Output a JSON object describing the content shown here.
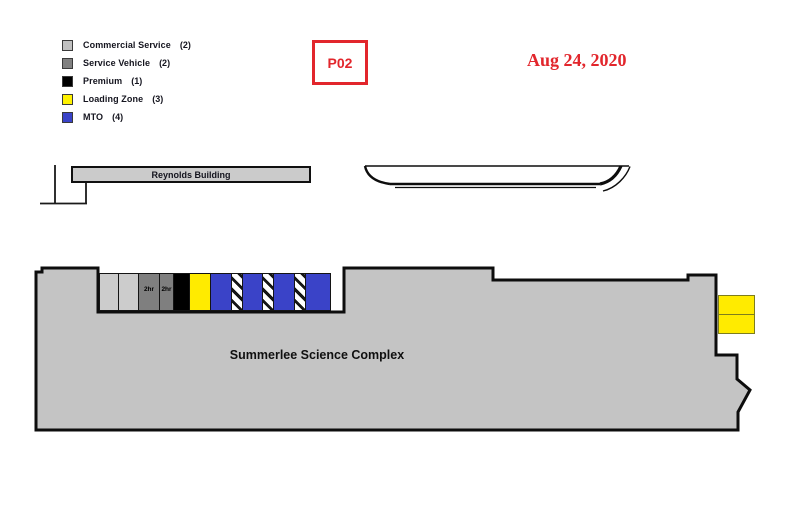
{
  "map_label": {
    "text": "P02",
    "color": "#E2262C"
  },
  "date": {
    "text": "Aug 24, 2020",
    "color": "#E2262C"
  },
  "legend": {
    "items": [
      {
        "label": "Commercial Service",
        "count": "(2)",
        "color": "#C0C0C0"
      },
      {
        "label": "Service Vehicle",
        "count": "(2)",
        "color": "#808080"
      },
      {
        "label": "Premium",
        "count": "(1)",
        "color": "#000000"
      },
      {
        "label": "Loading Zone",
        "count": "(3)",
        "color": "#FFF200"
      },
      {
        "label": "MTO",
        "count": "(4)",
        "color": "#3A43C8"
      }
    ]
  },
  "buildings": {
    "reynolds": {
      "name": "Reynolds Building"
    },
    "summerlee": {
      "name": "Summerlee Science Complex"
    }
  },
  "parking": {
    "stall_colors": {
      "commercial": "#CCCCCC",
      "service": "#7F7F7F",
      "premium": "#000000",
      "loading": "#FFEB00",
      "mto": "#3A43C8",
      "hatched": "#FFFFFF"
    },
    "stalls": [
      {
        "type": "commercial"
      },
      {
        "type": "commercial"
      },
      {
        "type": "service",
        "label": "2hr"
      },
      {
        "type": "service",
        "label": "2hr"
      },
      {
        "type": "premium"
      },
      {
        "type": "loading"
      },
      {
        "type": "mto"
      },
      {
        "type": "hatched"
      },
      {
        "type": "mto"
      },
      {
        "type": "hatched"
      },
      {
        "type": "mto"
      },
      {
        "type": "hatched"
      },
      {
        "type": "mto"
      }
    ],
    "loading_dock": {
      "cells": 2,
      "color": "#FFEB00"
    }
  }
}
